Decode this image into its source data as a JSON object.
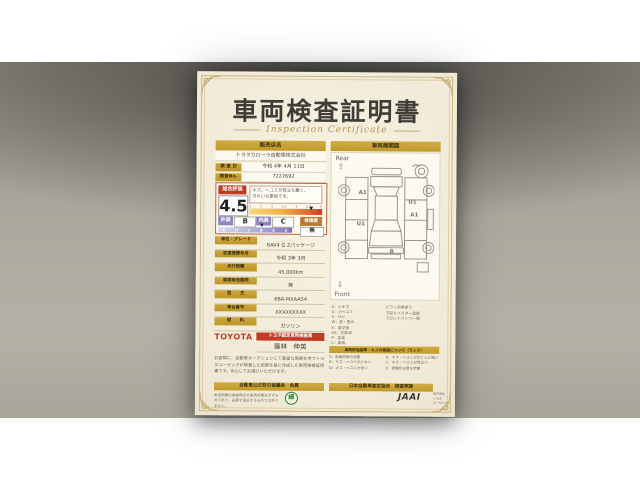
{
  "colors": {
    "gold": "#c7a13b",
    "red": "#c23b27",
    "purple": "#8f86bf",
    "repair": "#b97a35",
    "ink": "#474440"
  },
  "doc": {
    "title": "車両検査証明書",
    "subtitle": "Inspection Certificate",
    "left": {
      "dealer_header": "販売店名",
      "dealer_name": "トヨタカローラ自動車株式会社",
      "meta": [
        {
          "label": "検 査 日",
          "value": "令和 4年 4月 11日"
        },
        {
          "label": "検査No.",
          "value": "7227692"
        }
      ],
      "rating": {
        "badge": "総合評価",
        "score": "4.5",
        "comment_1": "キズ、ヘコミが目立ち難く、",
        "comment_2": "きれいな車両です。",
        "score_scale": [
          "1",
          "2",
          "3",
          "3.5",
          "4",
          "4.5",
          "5"
        ],
        "marker": "▼",
        "ext_label": "外装",
        "ext_value": "B",
        "int_label": "内装",
        "int_value": "C",
        "grade_scale": [
          "E",
          "D",
          "C",
          "B",
          "A",
          "S"
        ],
        "repair_label": "修復歴",
        "repair_value": "無"
      },
      "specs": [
        {
          "label": "車名・グレード",
          "value": "RAV4 G Zパッケージ"
        },
        {
          "label": "初度登録年月",
          "value": "令和 3年 3月"
        },
        {
          "label": "走行距離",
          "value": "45,000km"
        },
        {
          "label": "車検有効期限",
          "value": "無"
        },
        {
          "label": "型　　式",
          "value": "6BA-MXAA54"
        },
        {
          "label": "車台番号",
          "value": "XXXXXXXXX"
        },
        {
          "label": "燃　　料",
          "value": "ガソリン"
        }
      ],
      "inspector": {
        "brand": "TOYOTA",
        "badge": "トヨタ認定車両検査員",
        "name": "藤林　伸英"
      },
      "disclaimer": "お客様に、自動車オークションにて豊富な実績を持つトヨタユーゼックが検査した結果を基に作成した車両検査証明書です。安心してお選びいただけます。"
    },
    "right": {
      "header": "車両展開図",
      "rear_label": "Rear",
      "front_label": "Front",
      "rear_arrow": "⇧",
      "front_arrow": "⇩",
      "markers": [
        "A1",
        "U1",
        "A1",
        "U1",
        "B"
      ],
      "legend": [
        "A：小キズ",
        "U：小ヘコミ",
        "S：サビ",
        "W：波・歪み",
        "X：要交換",
        "XX：交換済",
        "P：塗装",
        "C：腐食"
      ],
      "notes": [
        "ピラー交換あり",
        "下回りパスター塗装",
        "フロントバンパー傷"
      ],
      "criteria_header": "車両評価基準・キズの程度について（ランク）",
      "criteria": [
        "S：新車同様の状態",
        "A：キズ・ヘコミがほとんど無い",
        "B：キズ・ヘコミが少ない",
        "C：キズ・ヘコミが目立つ",
        "D：キズ・ヘコミが多い",
        "E：修理が必要な状態"
      ]
    },
    "footer": {
      "left_bar": "自動車公正取引協議会　会員",
      "right_bar": "日本自動車査定協会　検査実施",
      "left_note": "本証明書は検査時点の車両状態を示すものであり、品質を保証するものではありません。",
      "emblem": "緑",
      "jaai": "JAAI",
      "right_note": [
        "株式会社",
        "トヨタ",
        "ユーゼック"
      ]
    }
  }
}
